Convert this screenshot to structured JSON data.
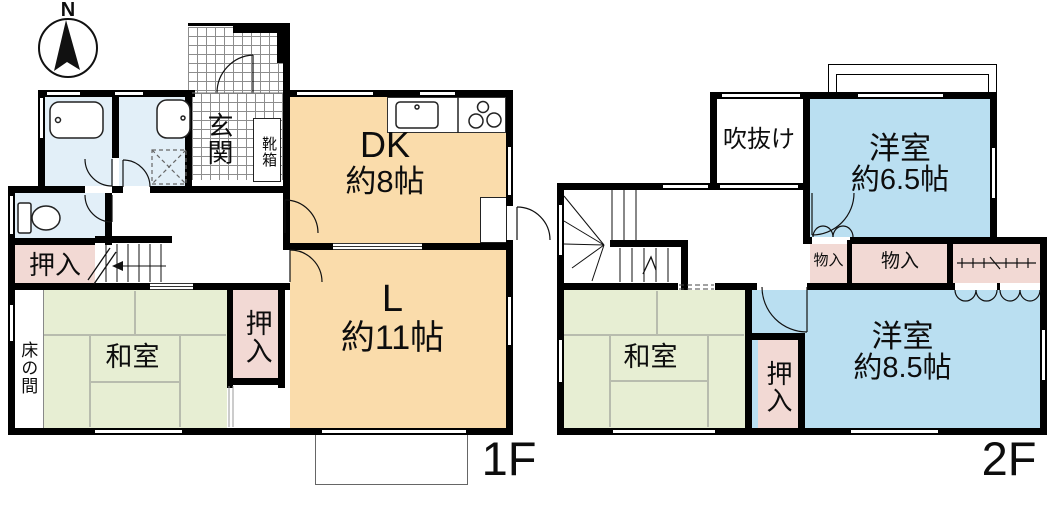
{
  "compass": {
    "north_label": "N"
  },
  "floor_1f": {
    "floor_label": "1F",
    "rooms": {
      "dk": {
        "name": "DK",
        "size": "約8帖"
      },
      "living": {
        "name": "L",
        "size": "約11帖"
      },
      "washitsu": {
        "name": "和室"
      },
      "tokonoma": {
        "name": "床の間"
      },
      "oshiire_nw": {
        "name": "押入"
      },
      "oshiire_e": {
        "name": "押入"
      },
      "genkan": {
        "name": "玄関"
      },
      "kutsubako": {
        "name": "靴箱"
      }
    }
  },
  "floor_2f": {
    "floor_label": "2F",
    "rooms": {
      "fukinuke": {
        "name": "吹抜け"
      },
      "yoshitsu_65": {
        "name": "洋室",
        "size": "約6.5帖"
      },
      "yoshitsu_85": {
        "name": "洋室",
        "size": "約8.5帖"
      },
      "washitsu": {
        "name": "和室"
      },
      "oshiire": {
        "name": "押入"
      },
      "monoire_w": {
        "name": "物入"
      },
      "monoire_e": {
        "name": "物入"
      }
    }
  },
  "colors": {
    "wall": "#000000",
    "room_dk_l": "#fadcab",
    "room_tatami": "#e7eed3",
    "room_western": "#badff1",
    "room_closet": "#f2d9d4",
    "room_bath": "#e2eff8"
  }
}
